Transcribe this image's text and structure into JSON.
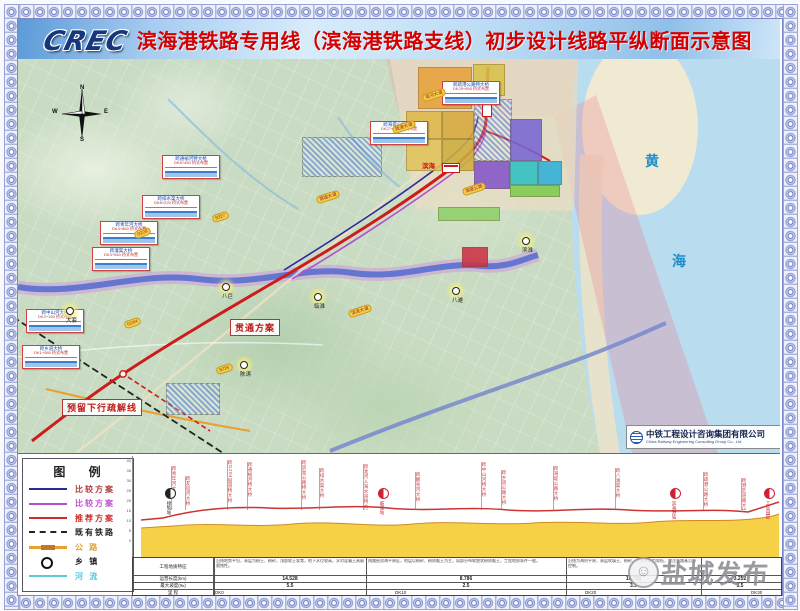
{
  "title": "滨海港铁路专用线（滨海港铁路支线）初步设计线路平纵断面示意图",
  "logo_text": "CREC",
  "colors": {
    "recommended": "#cc2222",
    "compare1": "#2a2a9c",
    "compare2": "#b44fd0",
    "existing_rail": "#222222",
    "road": "#e8a030",
    "river": "#5bc8dc",
    "sea": "#b9dcee",
    "terrain": "#f5cf3e",
    "title_red": "#d40000"
  },
  "map": {
    "sea": [
      "黄",
      "海"
    ],
    "compass": {
      "n": "N",
      "s": "S",
      "e": "E",
      "w": "W"
    },
    "scheme_labels": {
      "through": "贯通方案",
      "reserved": "预留下行疏解线"
    },
    "station_label": "滨海",
    "attribution_cn": "中铁工程设计咨询集团有限公司",
    "attribution_en": "China Railway Engineering Consulting Group Co., Ltd",
    "towns": [
      {
        "name": "大套",
        "x": 48,
        "y": 248
      },
      {
        "name": "八巨",
        "x": 204,
        "y": 224
      },
      {
        "name": "陈涛",
        "x": 222,
        "y": 302
      },
      {
        "name": "临淮",
        "x": 296,
        "y": 234
      },
      {
        "name": "八滩",
        "x": 434,
        "y": 228
      },
      {
        "name": "滨淮",
        "x": 504,
        "y": 178
      }
    ],
    "road_badges": [
      {
        "t": "G228",
        "x": 116,
        "y": 170
      },
      {
        "t": "S327",
        "x": 194,
        "y": 154
      },
      {
        "t": "G204",
        "x": 106,
        "y": 260
      },
      {
        "t": "疏港大道",
        "x": 374,
        "y": 64
      },
      {
        "t": "淮河大道",
        "x": 404,
        "y": 32
      },
      {
        "t": "海堤公路",
        "x": 444,
        "y": 126
      },
      {
        "t": "港城大道",
        "x": 298,
        "y": 134
      },
      {
        "t": "S226",
        "x": 198,
        "y": 306
      },
      {
        "t": "滨淮大道",
        "x": 330,
        "y": 248
      }
    ],
    "callouts": [
      {
        "x": 424,
        "y": 22,
        "t": "跨疏港公路特大桥",
        "s": "DK29+850 桥式布置"
      },
      {
        "x": 352,
        "y": 62,
        "t": "跨海堤公路大桥",
        "s": "DK27+300 桥式布置"
      },
      {
        "x": 144,
        "y": 96,
        "t": "跨通榆河特大桥",
        "s": "DK6+450 桥式布置"
      },
      {
        "x": 124,
        "y": 136,
        "t": "跨排水渠大桥",
        "s": "DK8+220 桥式布置"
      },
      {
        "x": 82,
        "y": 162,
        "t": "跨青年河大桥",
        "s": "DK4+860 桥式布置"
      },
      {
        "x": 74,
        "y": 188,
        "t": "跨灌渠大桥",
        "s": "DK3+540 桥式布置"
      },
      {
        "x": 8,
        "y": 250,
        "t": "跨中山河大桥",
        "s": "DK2+150 桥式布置"
      },
      {
        "x": 4,
        "y": 286,
        "t": "跨乡道大桥",
        "s": "DK1+080 桥式布置"
      }
    ]
  },
  "legend": {
    "title": "图  例",
    "items": [
      {
        "label": "比较方案",
        "type": "line",
        "color": "#2a2a9c",
        "text_color": "#b03a3a"
      },
      {
        "label": "比较方案",
        "type": "line",
        "color": "#b44fd0",
        "text_color": "#c04fd0"
      },
      {
        "label": "推荐方案",
        "type": "line",
        "color": "#cc2a2a",
        "text_color": "#cc2a2a"
      },
      {
        "label": "既有铁路",
        "type": "dash",
        "color": "#222222",
        "text_color": "#222222"
      },
      {
        "label": "公  路",
        "type": "road",
        "color": "#e8a030",
        "text_color": "#e0a030"
      },
      {
        "label": "乡  镇",
        "type": "circle",
        "color": "#111111",
        "text_color": "#222222"
      },
      {
        "label": "河  流",
        "type": "line",
        "color": "#5bc8dc",
        "text_color": "#5bc8dc"
      }
    ]
  },
  "profile": {
    "axis_ticks": [
      "40",
      "35",
      "30",
      "25",
      "20",
      "15",
      "10",
      "5",
      "0"
    ],
    "stations": [
      {
        "name": "接轨站",
        "x": 32,
        "color": "#222222"
      },
      {
        "name": "临淮站",
        "x": 245,
        "color": "#cc2233"
      },
      {
        "name": "滨海港站",
        "x": 537,
        "color": "#cc2233"
      },
      {
        "name": "工业园区",
        "x": 631,
        "color": "#cc2233"
      }
    ],
    "annotations": [
      {
        "x": 38,
        "h": 44,
        "t": "跨青年河大桥"
      },
      {
        "x": 52,
        "h": 34,
        "t": "跨友谊河大桥"
      },
      {
        "x": 94,
        "h": 50,
        "t": "跨G204国道特大桥"
      },
      {
        "x": 114,
        "h": 48,
        "t": "跨通榆河特大桥"
      },
      {
        "x": 168,
        "h": 50,
        "t": "跨滨淮公路特大桥"
      },
      {
        "x": 186,
        "h": 42,
        "t": "跨排水渠大桥"
      },
      {
        "x": 230,
        "h": 46,
        "t": "跨淮河入海水道特大桥"
      },
      {
        "x": 282,
        "h": 38,
        "t": "跨翻身河大桥"
      },
      {
        "x": 348,
        "h": 48,
        "t": "跨中山河特大桥"
      },
      {
        "x": 368,
        "h": 40,
        "t": "跨乡道公路大桥"
      },
      {
        "x": 420,
        "h": 44,
        "t": "跨海堤公路大桥"
      },
      {
        "x": 482,
        "h": 42,
        "t": "跨八滩渠大桥"
      },
      {
        "x": 570,
        "h": 38,
        "t": "跨疏港公路大桥"
      },
      {
        "x": 608,
        "h": 32,
        "t": "跨港区道路大桥"
      }
    ],
    "table": {
      "row_labels": [
        "工程地质特征",
        "运营长度(km)",
        "最大坡度(‰)",
        "里  程"
      ],
      "sections": [
        {
          "left": 81,
          "width": 152,
          "len": "14.528",
          "slope": "5.5",
          "geo": "沿线地势平坦，表层为粉土、粉砂，浅部软土发育，地下水位较高，水对混凝土具弱腐蚀性。"
        },
        {
          "left": 233,
          "width": 200,
          "len": "8.786",
          "slope": "2.5",
          "geo": "线路经滨海平原区，地层以粉砂、粉质黏土为主，局部分布软塑状粉质黏土，工程地质条件一般。"
        },
        {
          "left": 433,
          "width": 135,
          "len": "10.756",
          "slope": "3.5",
          "geo": "沿线为海积平原，表层吹填土、粉砂，地基承载力较低，需注意路基沉降控制。"
        },
        {
          "left": 568,
          "width": 78,
          "len": "3.252",
          "slope": "5.5",
          "geo": ""
        }
      ],
      "mileposts": [
        {
          "t": "DK0",
          "x": 82
        },
        {
          "t": "DK10",
          "x": 262
        },
        {
          "t": "DK20",
          "x": 452
        },
        {
          "t": "DK30",
          "x": 618
        }
      ]
    }
  },
  "watermark": "盐城发布"
}
